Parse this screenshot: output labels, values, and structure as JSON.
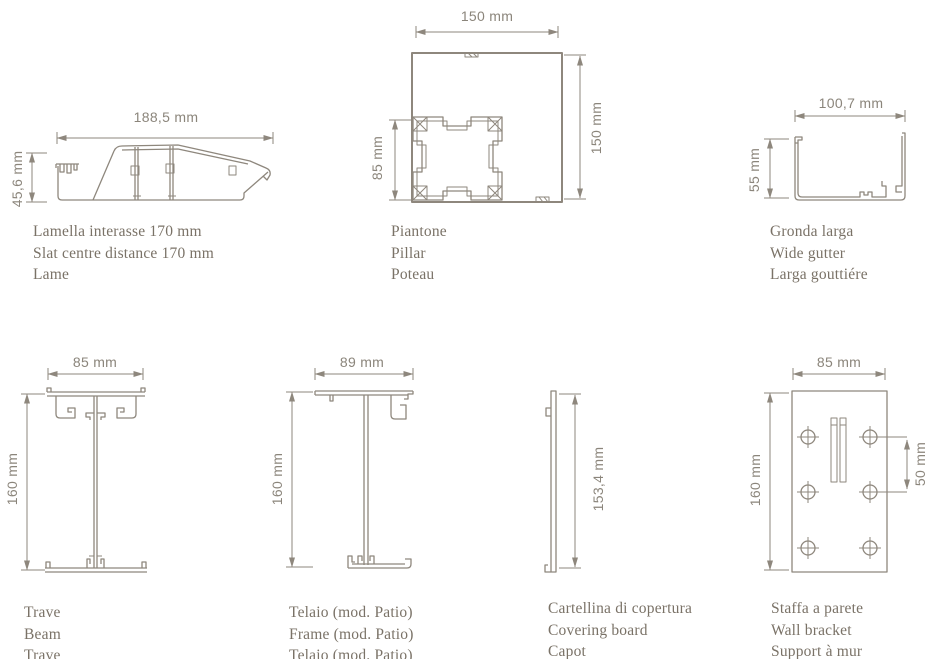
{
  "colors": {
    "background": "#ffffff",
    "line": "#8e877d",
    "dimension_text": "#8b857b",
    "label_text": "#7a7267"
  },
  "figures": {
    "slat": {
      "width_dim": "188,5 mm",
      "height_dim": "45,6 mm",
      "labels": [
        "Lamella interasse 170 mm",
        "Slat centre distance 170 mm",
        "Lame"
      ]
    },
    "pillar": {
      "width_dim": "150 mm",
      "height_dim": "150 mm",
      "inner_dim": "85 mm",
      "labels": [
        "Piantone",
        "Pillar",
        "Poteau"
      ]
    },
    "gutter": {
      "width_dim": "100,7 mm",
      "height_dim": "55 mm",
      "labels": [
        "Gronda larga",
        "Wide gutter",
        "Larga gouttiére"
      ]
    },
    "beam": {
      "width_dim": "85 mm",
      "height_dim": "160 mm",
      "labels": [
        "Trave",
        "Beam",
        "Trave"
      ]
    },
    "frame": {
      "width_dim": "89 mm",
      "height_dim": "160 mm",
      "labels": [
        "Telaio (mod. Patio)",
        "Frame (mod. Patio)",
        "Telaio (mod. Patio)"
      ]
    },
    "covering_board": {
      "height_dim": "153,4 mm",
      "labels": [
        "Cartellina di copertura",
        "Covering board",
        "Capot"
      ]
    },
    "wall_bracket": {
      "width_dim": "85 mm",
      "height_dim": "160 mm",
      "hole_spacing_dim": "50 mm",
      "labels": [
        "Staffa a parete",
        "Wall bracket",
        "Support à mur"
      ]
    }
  }
}
